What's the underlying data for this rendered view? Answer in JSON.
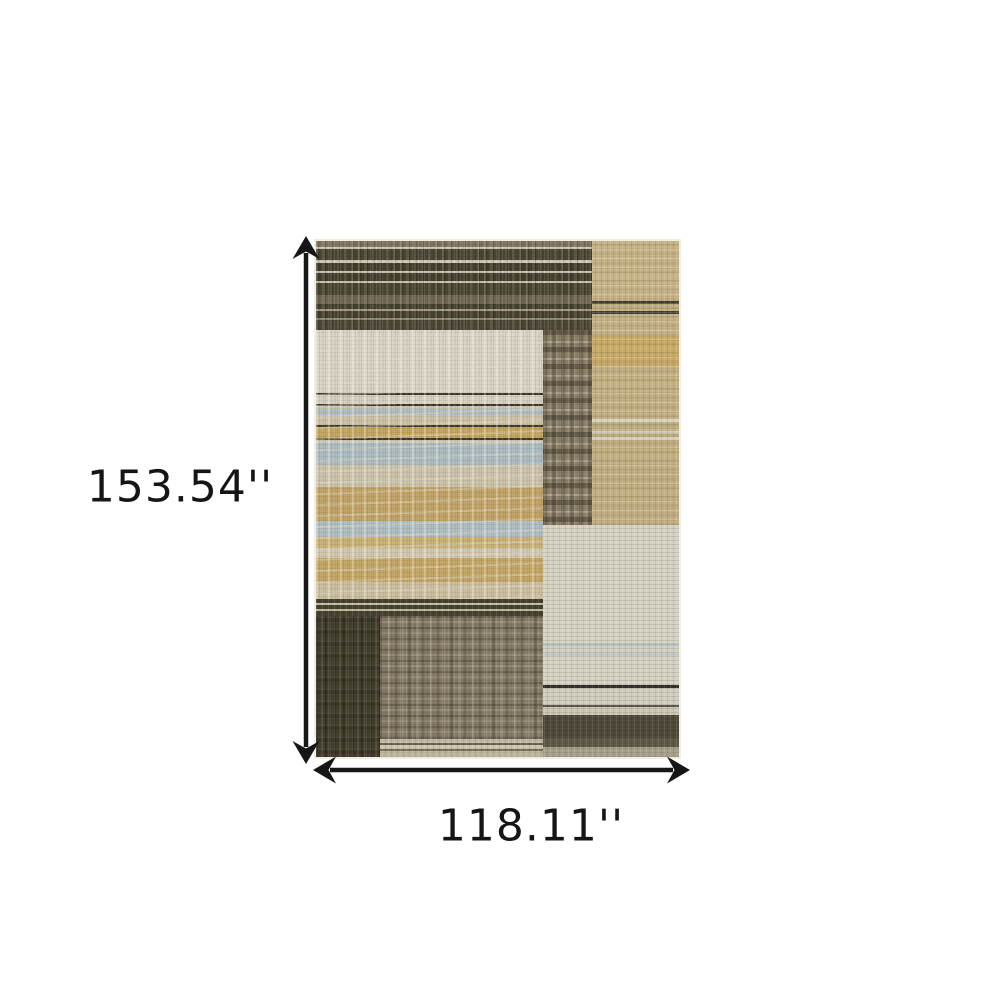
{
  "page": {
    "background_color": "#ffffff",
    "content": "product dimension diagram of an area rug"
  },
  "dimensions": {
    "height_label": "153.54''",
    "width_label": "118.11''",
    "arrow_color": "#161616",
    "label_color": "#151515"
  },
  "rug": {
    "description": "abstract distressed patchwork area rug with horizontal stripes",
    "palette": {
      "charcoal": "#46412f",
      "cream": "#d9d4c4",
      "tan": "#c3b184",
      "gold": "#c4a462",
      "blue_gray": "#aebdc1",
      "taupe_seam": "#8c8068",
      "brown_gray": "#7b7260",
      "dark_line": "#3d392c",
      "light_edge": "#f0ede2"
    },
    "zones": [
      "top-left-charcoal-stripe-block",
      "top-right-tan-block",
      "center-taupe-seam-column",
      "left-cream-gold-blue-stripe-block",
      "bottom-left-charcoal-block",
      "bottom-center-brown-gray-block",
      "bottom-right-light-beige-block"
    ]
  }
}
